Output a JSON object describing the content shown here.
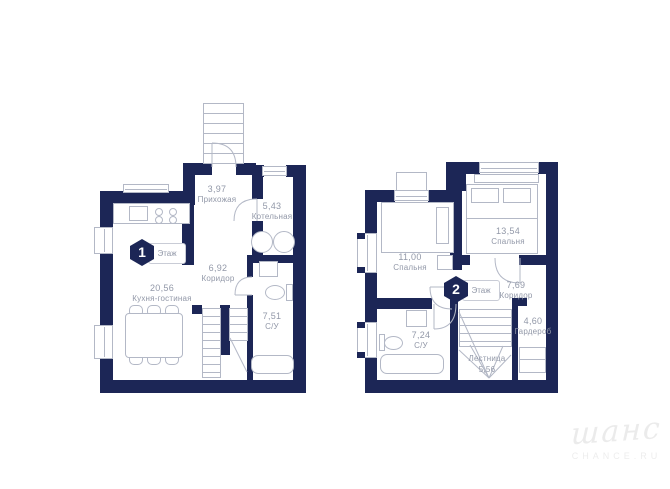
{
  "colors": {
    "wall": "#1c2656",
    "outline": "#b3b8c6",
    "label_text": "#9298a8",
    "watermark": "#ebebeb"
  },
  "floor1": {
    "badge": {
      "number": "1",
      "label": "Этаж"
    },
    "rooms": {
      "hallway": {
        "area": "3,97",
        "name": "Прихожая"
      },
      "boiler": {
        "area": "5,43",
        "name": "Котельная"
      },
      "corridor": {
        "area": "6,92",
        "name": "Коридор"
      },
      "kitchen_living": {
        "area": "20,56",
        "name": "Кухня-гостиная"
      },
      "bathroom": {
        "area": "7,51",
        "name": "С/У"
      }
    }
  },
  "floor2": {
    "badge": {
      "number": "2",
      "label": "Этаж"
    },
    "rooms": {
      "bedroom_small": {
        "area": "11,00",
        "name": "Спальня"
      },
      "bedroom_big": {
        "area": "13,54",
        "name": "Спальня"
      },
      "corridor": {
        "area": "7,69",
        "name": "Коридор"
      },
      "wardrobe": {
        "area": "4,60",
        "name": "Гардероб"
      },
      "bathroom": {
        "area": "7,24",
        "name": "С/У"
      },
      "stairs": {
        "area": "5,56",
        "name": "Лестница"
      }
    }
  },
  "watermark": {
    "logo": "шанс",
    "domain": "CHANCE.RU"
  }
}
